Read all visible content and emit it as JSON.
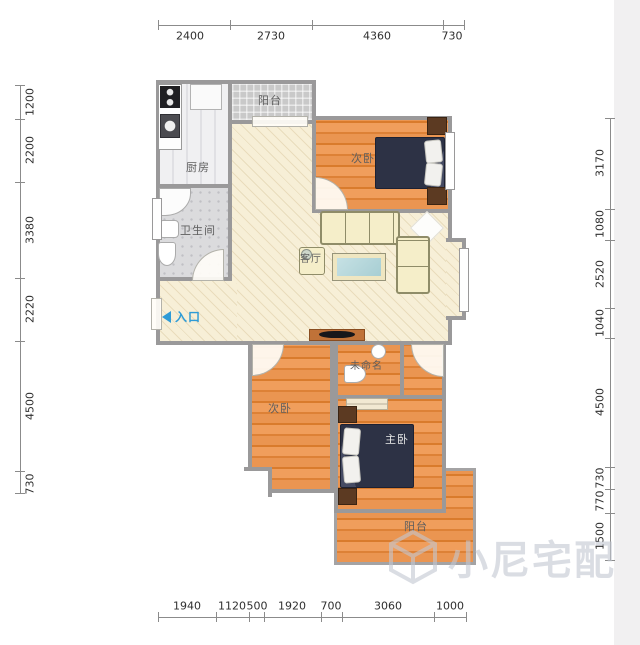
{
  "dims": {
    "top": [
      "2400",
      "2730",
      "4360",
      "730"
    ],
    "left": [
      "1200",
      "2200",
      "3380",
      "2220",
      "4500",
      "730"
    ],
    "right": [
      "3170",
      "1080",
      "2520",
      "1040",
      "4500",
      "730",
      "770",
      "1500"
    ],
    "bottom": [
      "1940",
      "1120",
      "500",
      "1920",
      "700",
      "3060",
      "1000"
    ]
  },
  "rooms": {
    "kitchen": "厨房",
    "balcony_top": "阳台",
    "bathroom": "卫生间",
    "living": "客厅",
    "bedroom_top": "次卧",
    "bedroom_left": "次卧",
    "master": "主卧",
    "unnamed": "未命名",
    "balcony_bottom": "阳台",
    "entrance": "入口"
  },
  "watermark": {
    "text": "小尼宅配"
  },
  "colors": {
    "wall": "#9a999a",
    "wood_floor": "#e8914e",
    "living_floor": "#f6eed4",
    "entrance_blue": "#2e9bd6",
    "bed_navy": "#2d3245"
  }
}
